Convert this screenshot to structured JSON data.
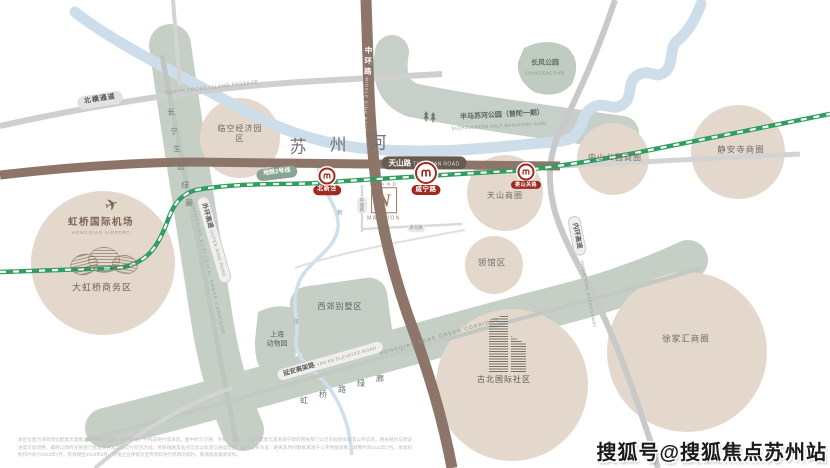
{
  "map": {
    "watermark": "搜狐号@搜狐焦点苏州站",
    "disclaimer": "本区位图为项目周边配套示意图，非精确测绘图，仅供参考，不构成要约或承诺。图中所示交通、学校、商业、公园等配套信息来源于政府相关部门公示的规划资料及公开信息，相关规划与建设进度可能调整，最终以政府主管部门批准文件及实际交付状况为准。地铁线路及站点信息以轨道交通运营部门最终公布为准；距离及时间数据来源于公开地图测算，测算时间2023年7月。本资料制作时间为2023年7月，有效期至2023年8月，开发企业保留对宣传资料进行修改的权利，敬请留意最新资料。",
    "river": {
      "name_chars": [
        "苏",
        "州",
        "河"
      ],
      "creek_chars": [
        "新",
        "泾"
      ]
    },
    "roads": {
      "north_cross": {
        "cn": "北横通道",
        "en": "NORTH CROSS ISLAND PASSAGE"
      },
      "middle_ring": {
        "cn": "中环路",
        "en": "MIDDLE RING ROAD"
      },
      "tianshan": {
        "cn": "天山路",
        "en": "TIANSHAN ROAD"
      },
      "outer_ring": {
        "cn": "外环高速",
        "en": "OUTER RING ROAD"
      },
      "inner_ring": {
        "cn": "内环高速",
        "en": "INNER RING EXPRESSWAY"
      },
      "yanan": {
        "cn": "延安高架路",
        "en": "YAN'AN ELEVATED ROAD"
      },
      "pingtang": "平塘路",
      "maotai": "茅台路"
    },
    "metro": {
      "line_label": "地铁2号线",
      "stations": [
        "北新泾",
        "威宁路",
        "娄山关路"
      ]
    },
    "corridors": {
      "changning": {
        "chars": [
          "长",
          "宁",
          "生",
          "态",
          "绿",
          "圈"
        ],
        "en": "CHANGNING ECOLOGICAL GREEN CORRIDOR"
      },
      "hongqiao": {
        "chars": [
          "虹",
          "桥",
          "路",
          "绿",
          "廊"
        ],
        "en": "HONGQIAO ROAD GREEN CORRIDOR"
      }
    },
    "parks": {
      "changfeng": {
        "cn": "长风公园",
        "en": "CHANGFENG PARK"
      },
      "banma": {
        "cn": "半马苏河公园（普陀一期）",
        "en": "SUZHOUCREEK HALF MARATHON PARK"
      }
    },
    "areas": {
      "linkong": "临空经济园区",
      "tianshan_biz": "天山商圈",
      "zhongshan": "中山公园商圈",
      "jingan": "静安寺商圈",
      "lingguan": "领馆区",
      "xujiahui": "徐家汇商圈",
      "xijiao": "西郊别墅区",
      "zoo_line1": "上海",
      "zoo_line2": "动物园",
      "gubei": "古北国际社区",
      "dahongqiao": "大虹桥商务区"
    },
    "airport": {
      "cn": "虹桥国际机场",
      "en": "HONGQIAO AIRPORT"
    },
    "logo": {
      "top": "GRAND",
      "letter": "N",
      "bottom": "MANSION"
    },
    "colors": {
      "metro_green": "#2f9e5f",
      "badge_red": "#a5281f",
      "road_brown": "#8d7669",
      "sage": "#c5cfc6",
      "tan": "#e4d8cc",
      "river_blue": "#cddde9"
    }
  }
}
